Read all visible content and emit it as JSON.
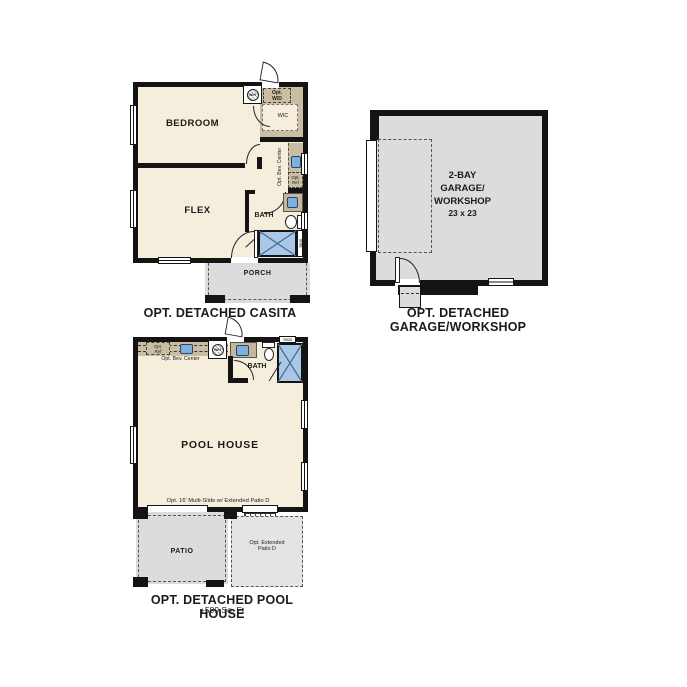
{
  "colors": {
    "wall": "#141414",
    "interior_cream": "#f6eedd",
    "counter_tan": "#cbbda2",
    "concrete_gray": "#dcdcdc",
    "shower_blue": "#a9c7e6",
    "sink_blue": "#7fb0dd"
  },
  "casita": {
    "caption": "OPT. DETACHED CASITA",
    "rooms": {
      "bedroom": "BEDROOM",
      "flex": "FLEX",
      "bath": "BATH",
      "wic": "WIC",
      "porch": "PORCH"
    },
    "labels": {
      "wh": "W/H",
      "opt_wd_1": "Opt.",
      "opt_wd_2": "W/D",
      "bev_center": "Opt. Bev. Center",
      "opt_ref_1": "Opt.",
      "opt_ref_2": "Ref",
      "seat": "Seat"
    }
  },
  "garage": {
    "caption": "OPT. DETACHED GARAGE/WORKSHOP",
    "label_lines": [
      "2-BAY",
      "GARAGE/",
      "WORKSHOP"
    ],
    "dimensions": "23 x 23"
  },
  "pool_house": {
    "caption": "OPT. DETACHED POOL HOUSE",
    "sqft": "+599 Sq. Ft",
    "rooms": {
      "main": "POOL HOUSE",
      "bath": "BATH",
      "patio": "PATIO"
    },
    "labels": {
      "wh": "W/H",
      "bev_center": "Opt. Bev. Center",
      "opt_ref_1": "Opt.",
      "opt_ref_2": "Ref",
      "seat": "Seat",
      "multislide": "Opt. 16' Multi-Slide w/ Extended Patio D",
      "ext_patio_1": "Opt. Extended",
      "ext_patio_2": "Patio D"
    }
  }
}
